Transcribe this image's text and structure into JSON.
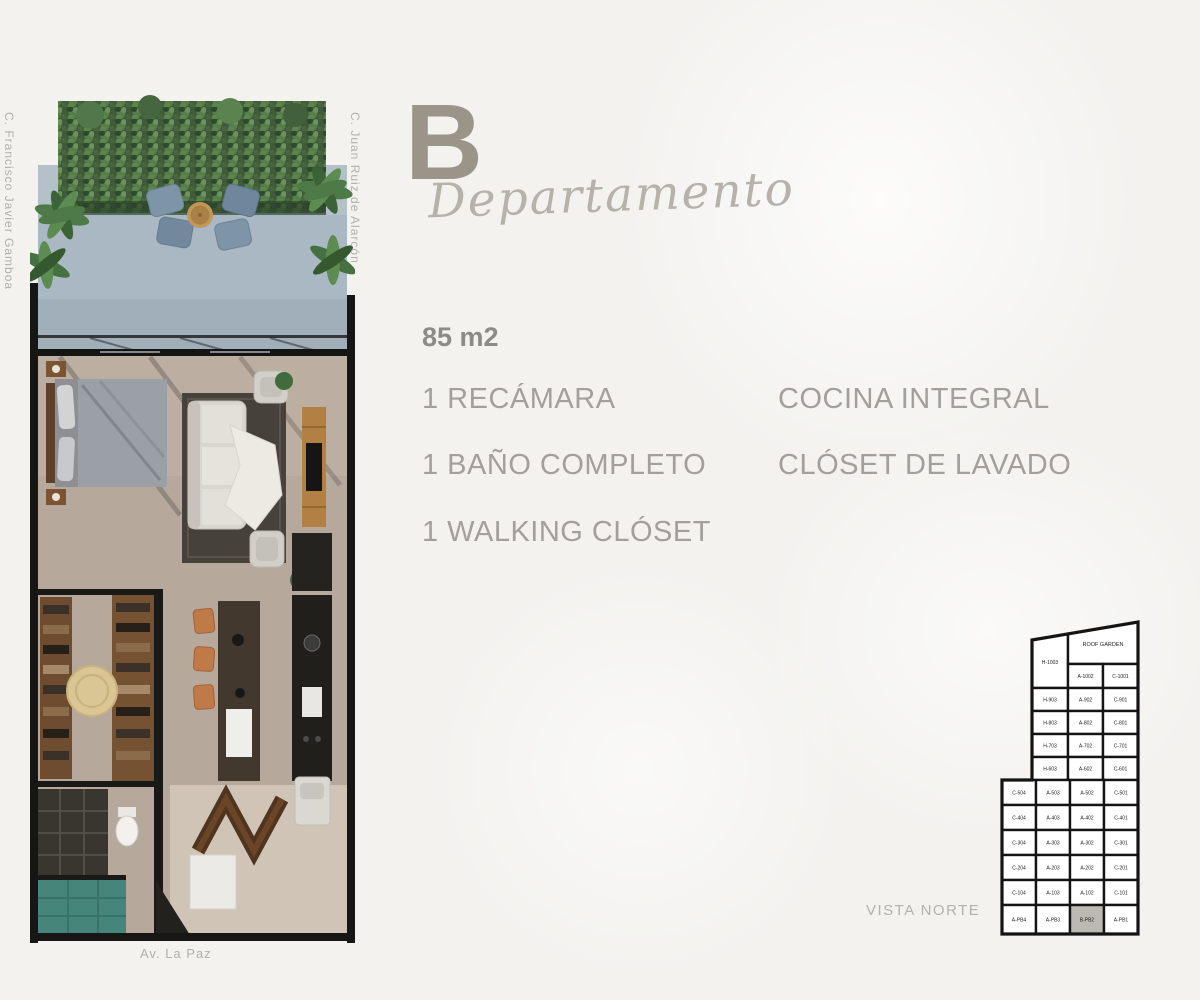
{
  "title": {
    "letter": "B",
    "word": "Departamento"
  },
  "specs": {
    "area": "85 m2",
    "features_left": [
      "1 RECÁMARA",
      "1 BAÑO COMPLETO",
      "1 WALKING CLÓSET"
    ],
    "features_right": [
      "COCINA INTEGRAL",
      "CLÓSET DE LAVADO"
    ]
  },
  "floor_plan": {
    "street_left": "C. Francisco Javier Gamboa",
    "street_right": "C. Juan Ruiz de Alarcón",
    "street_bottom": "Av. La Paz"
  },
  "building_map": {
    "caption": "VISTA NORTE",
    "highlighted_unit": "B-PB2",
    "highlight_color": "#bcb9b3",
    "cells": [
      "H-1003",
      "ROOF GARDEN",
      "A-1002",
      "C-1001",
      "H-903",
      "A-902",
      "C-901",
      "H-803",
      "A-802",
      "C-801",
      "H-703",
      "A-702",
      "C-701",
      "H-603",
      "A-602",
      "C-601",
      "C-504",
      "A-503",
      "A-502",
      "C-501",
      "C-404",
      "A-403",
      "A-402",
      "C-401",
      "C-304",
      "A-303",
      "A-302",
      "C-301",
      "C-204",
      "A-203",
      "A-202",
      "C-201",
      "C-104",
      "A-103",
      "A-102",
      "C-101",
      "A-PB4",
      "A-PB3",
      "B-PB2",
      "A-PB1"
    ]
  },
  "colors": {
    "accent_text": "#9a9489",
    "feature_text": "#a3a09b",
    "label_text": "#b3b1ac"
  }
}
